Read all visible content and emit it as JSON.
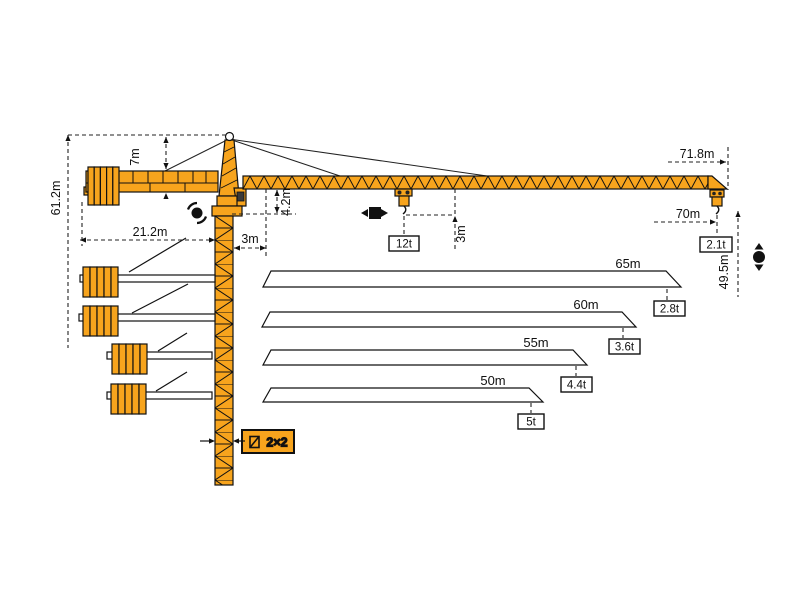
{
  "colors": {
    "crane_orange": "#F7A41D",
    "outline": "#111111",
    "cab_window": "#3a3a3a",
    "background": "#ffffff"
  },
  "labels": {
    "total_height": "61.2m",
    "head_height": "7m",
    "counterjib_radius": "21.2m",
    "min_radius": "3m",
    "root_hook_clearance": "4.2m",
    "trolley_hook_drop": "3m",
    "max_load": "12t",
    "max_jib_radius": "71.8m",
    "tip_radius": "70m",
    "tip_load": "2.1t",
    "hook_height": "49.5m",
    "mast_section": "2×2"
  },
  "jib_options": [
    {
      "length": "65m",
      "capacity": "2.8t"
    },
    {
      "length": "60m",
      "capacity": "3.6t"
    },
    {
      "length": "55m",
      "capacity": "4.4t"
    },
    {
      "length": "50m",
      "capacity": "5t"
    }
  ],
  "icons": {
    "slewing": "slew-rotation-icon",
    "trolley": "trolley-travel-icon",
    "hoist": "hook-hoist-icon",
    "mast_section": "mast-cross-section-icon"
  }
}
